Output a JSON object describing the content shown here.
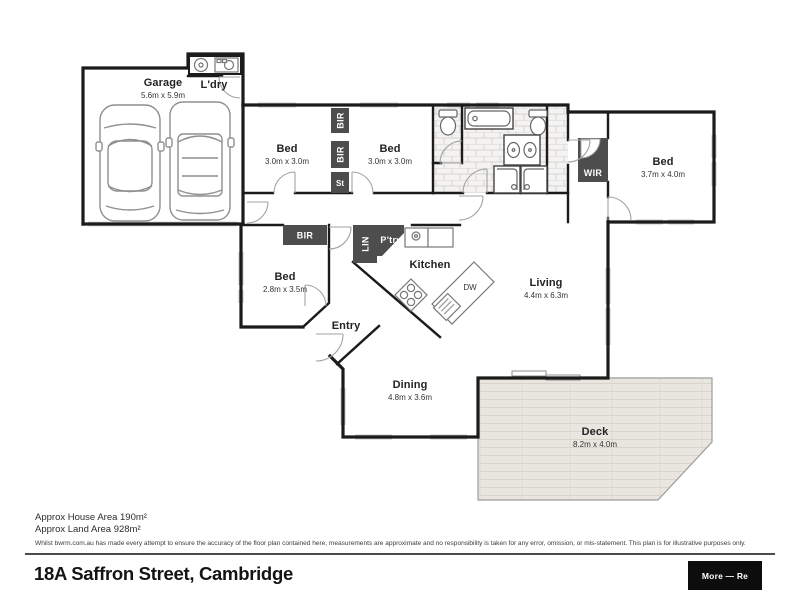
{
  "plan": {
    "rooms": [
      {
        "name": "Garage",
        "dims": "5.6m x 5.9m"
      },
      {
        "name": "L'dry",
        "dims": ""
      },
      {
        "name": "Bed",
        "dims": "3.0m x 3.0m"
      },
      {
        "name": "Bed",
        "dims": "3.0m x 3.0m"
      },
      {
        "name": "Bed",
        "dims": "3.7m x 4.0m"
      },
      {
        "name": "Bed",
        "dims": "2.8m x 3.5m"
      },
      {
        "name": "Kitchen",
        "dims": ""
      },
      {
        "name": "Living",
        "dims": "4.4m x 6.3m"
      },
      {
        "name": "Entry",
        "dims": ""
      },
      {
        "name": "Dining",
        "dims": "4.8m x 3.6m"
      },
      {
        "name": "Deck",
        "dims": "8.2m x 4.0m"
      }
    ],
    "storage": {
      "bir": "BIR",
      "st": "St",
      "wir": "WIR",
      "lin": "LIN",
      "pantry": "P'try",
      "dw": "DW"
    }
  },
  "footer": {
    "house_area": "Approx House Area 190m²",
    "land_area": "Approx Land Area 928m²",
    "disclaimer": "Whilst bwrm.com.au has made every attempt to ensure the accuracy of the floor plan contained here, measurements are approximate and no responsibility is taken for any error, omission, or mis-statement. This plan is for illustrative purposes only.",
    "address": "18A Saffron Street, Cambridge",
    "more_button": "More — Re"
  },
  "colors": {
    "wall": "#1b1b1b",
    "storage_box": "#4d4d4d",
    "button_black": "#0d0d0d"
  }
}
